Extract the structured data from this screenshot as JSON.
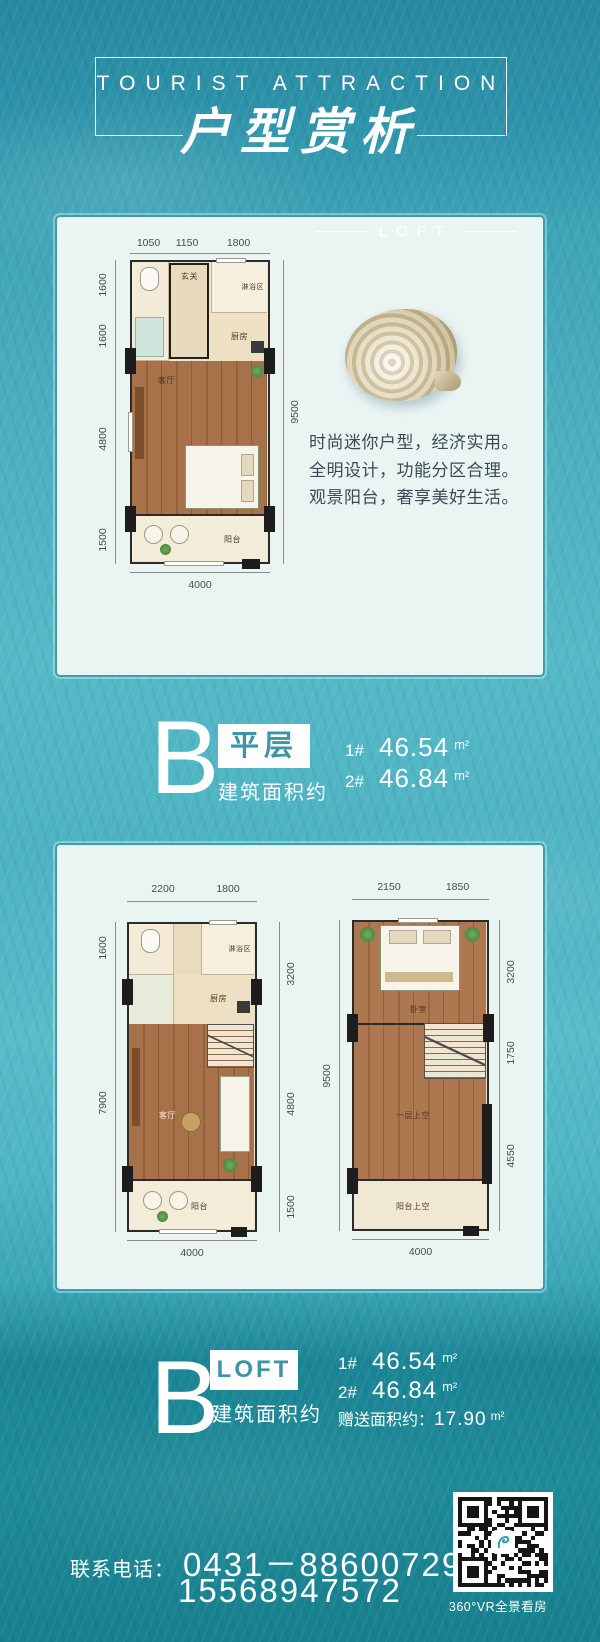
{
  "header": {
    "kicker": "TOURIST ATTRACTION",
    "title": "户型赏析"
  },
  "card_flat": {
    "tag": "LOFT",
    "plan": {
      "dims_top": [
        "1050",
        "1150",
        "1800"
      ],
      "dims_left": [
        "1600",
        "1600",
        "4800",
        "1500"
      ],
      "dim_right": "9500",
      "dim_bottom": "4000",
      "rooms": {
        "entry": "玄关",
        "shower": "淋浴区",
        "kitchen": "厨房",
        "living": "客厅",
        "balcony": "阳台"
      }
    },
    "description": [
      "时尚迷你户型，经济实用。",
      "全明设计，功能分区合理。",
      "观景阳台，奢享美好生活。"
    ]
  },
  "section_flat": {
    "letter": "B",
    "badge": "平层",
    "area_label": "建筑面积约",
    "areas": [
      {
        "no": "1#",
        "value": "46.54",
        "unit": "m²"
      },
      {
        "no": "2#",
        "value": "46.84",
        "unit": "m²"
      }
    ]
  },
  "card_loft": {
    "plan_lower": {
      "dims_top": [
        "2200",
        "1800"
      ],
      "dims_left": [
        "1600",
        "7900"
      ],
      "dims_right": [
        "3200",
        "4800",
        "1500"
      ],
      "dim_bottom": "4000",
      "rooms": {
        "shower": "淋浴区",
        "kitchen": "厨房",
        "living": "客厅",
        "balcony": "阳台"
      }
    },
    "plan_upper": {
      "dims_top": [
        "2150",
        "1850"
      ],
      "dim_left": "9500",
      "dims_right": [
        "3200",
        "1750",
        "4550"
      ],
      "dim_bottom": "4000",
      "rooms": {
        "bedroom": "卧室",
        "void": "一层上空",
        "balcony_void": "阳台上空"
      }
    }
  },
  "section_loft": {
    "letter": "B",
    "badge": "LOFT",
    "area_label": "建筑面积约",
    "areas": [
      {
        "no": "1#",
        "value": "46.54",
        "unit": "m²"
      },
      {
        "no": "2#",
        "value": "46.84",
        "unit": "m²"
      }
    ],
    "bonus_label": "赠送面积约：",
    "bonus_value": "17.90",
    "bonus_unit": "m²"
  },
  "footer": {
    "phone_label": "联系电话：",
    "phone_primary": "0431－88600729",
    "phone_secondary": "15568947572",
    "qr_caption": "360°VR全景看房"
  },
  "colors": {
    "accent_teal": "#38a0ae",
    "card_bg": "#e9f4f3",
    "wood": "#a7714a",
    "cream": "#efe4ca",
    "water_top": "#27899f",
    "water_bottom": "#17808e"
  }
}
